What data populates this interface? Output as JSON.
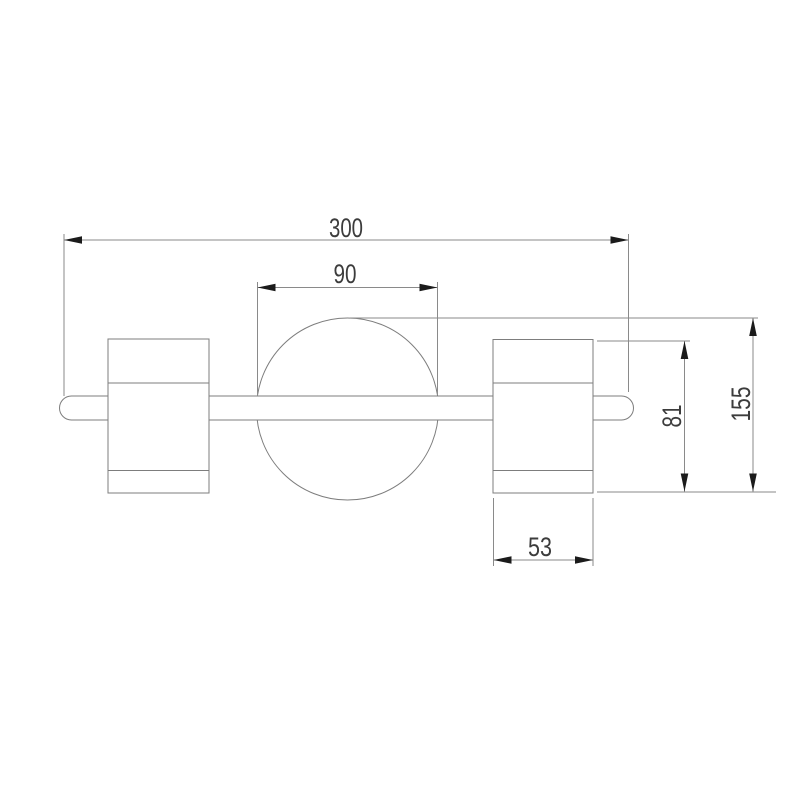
{
  "drawing": {
    "type": "technical-dimension-drawing",
    "subject": "two-head wall lamp with center ball joint, front view",
    "labels": {
      "overall_width": "300",
      "ball_diameter": "90",
      "shade_height": "81",
      "total_height": "155",
      "shade_width": "53"
    },
    "colors": {
      "background": "#ffffff",
      "outline": "#7d7d7d",
      "dimension_line": "#8a8a8a",
      "arrow": "#1b1b1b",
      "label_text": "#3c3c3c"
    }
  }
}
